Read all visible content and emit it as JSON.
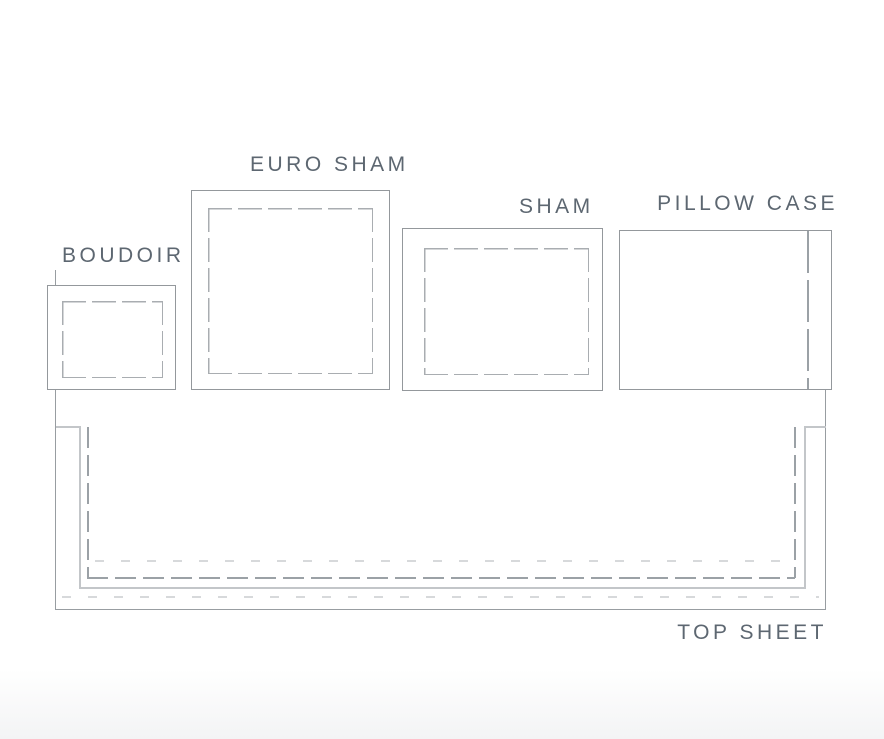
{
  "diagram": {
    "title": "Bedding pillow and sheet size diagram"
  },
  "items": [
    {
      "id": "boudoir",
      "label": "BOUDOIR"
    },
    {
      "id": "euro-sham",
      "label": "EURO SHAM"
    },
    {
      "id": "sham",
      "label": "SHAM"
    },
    {
      "id": "pillow-case",
      "label": "PILLOW CASE"
    },
    {
      "id": "top-sheet",
      "label": "TOP SHEET"
    }
  ],
  "colors": {
    "background": "#ffffff",
    "outline_gray": "#94989c",
    "sheet_outline_gray": "#989da1",
    "stitch_gray": "#a9adb1",
    "stitch_dark_gray": "#9ba1a6",
    "hem_light_gray": "#c3c6c9",
    "stitch_faint_gray": "#d7d9db",
    "label_text": "#5d6771",
    "bottom_fade": "#f3f4f5"
  }
}
